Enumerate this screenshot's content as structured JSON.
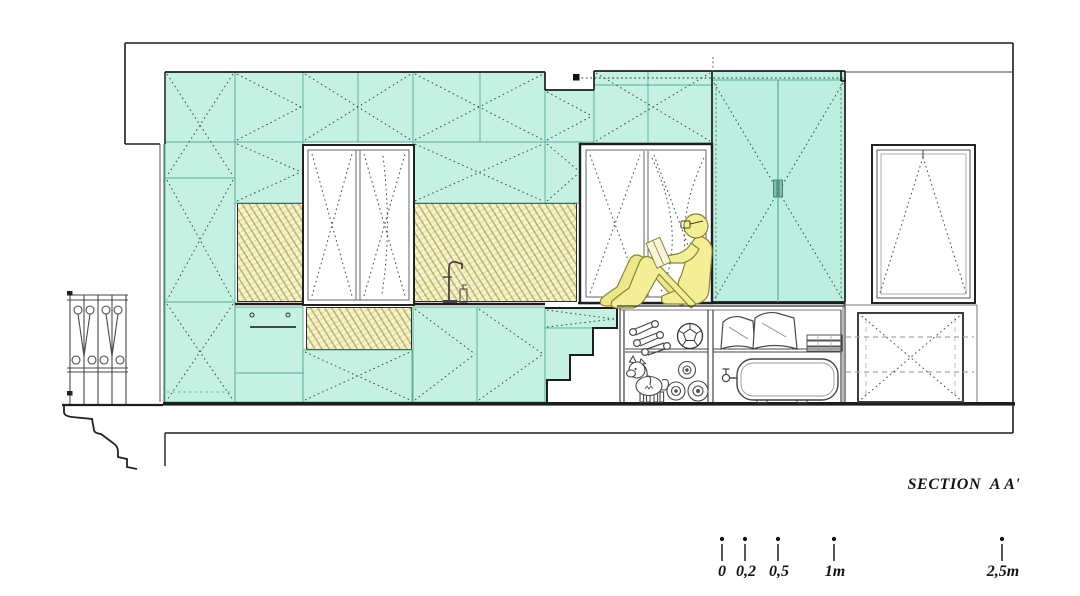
{
  "drawing": {
    "title": "SECTION  A A'",
    "type": "architectural cross-section of a micro-apartment",
    "scale_bar": {
      "unit_labels": [
        "0",
        "0,2",
        "0,5",
        "1m",
        "2,5m"
      ]
    },
    "palette": {
      "cabinet_teal": "#c5f1e3",
      "wardrobe_teal": "#bcefe0",
      "hatch_yellow": "#f8f3cd",
      "figure_yellow": "#f2ef97",
      "outline_dark": "#1d1d1d"
    },
    "scene_objects": [
      "wall-cabinets",
      "tall-wardrobe",
      "kitchen-window",
      "bed-alcove-window",
      "tilt-window",
      "reading-person",
      "kitchen-faucet",
      "oven-front",
      "storage-staircase",
      "dumbbells",
      "soccer-ball",
      "unicorn-plush",
      "rolled-mats",
      "pillows",
      "folded-linens",
      "water-tank",
      "balcony-railing",
      "cornice-molding",
      "dashed-storage-box",
      "curtain-track"
    ]
  }
}
